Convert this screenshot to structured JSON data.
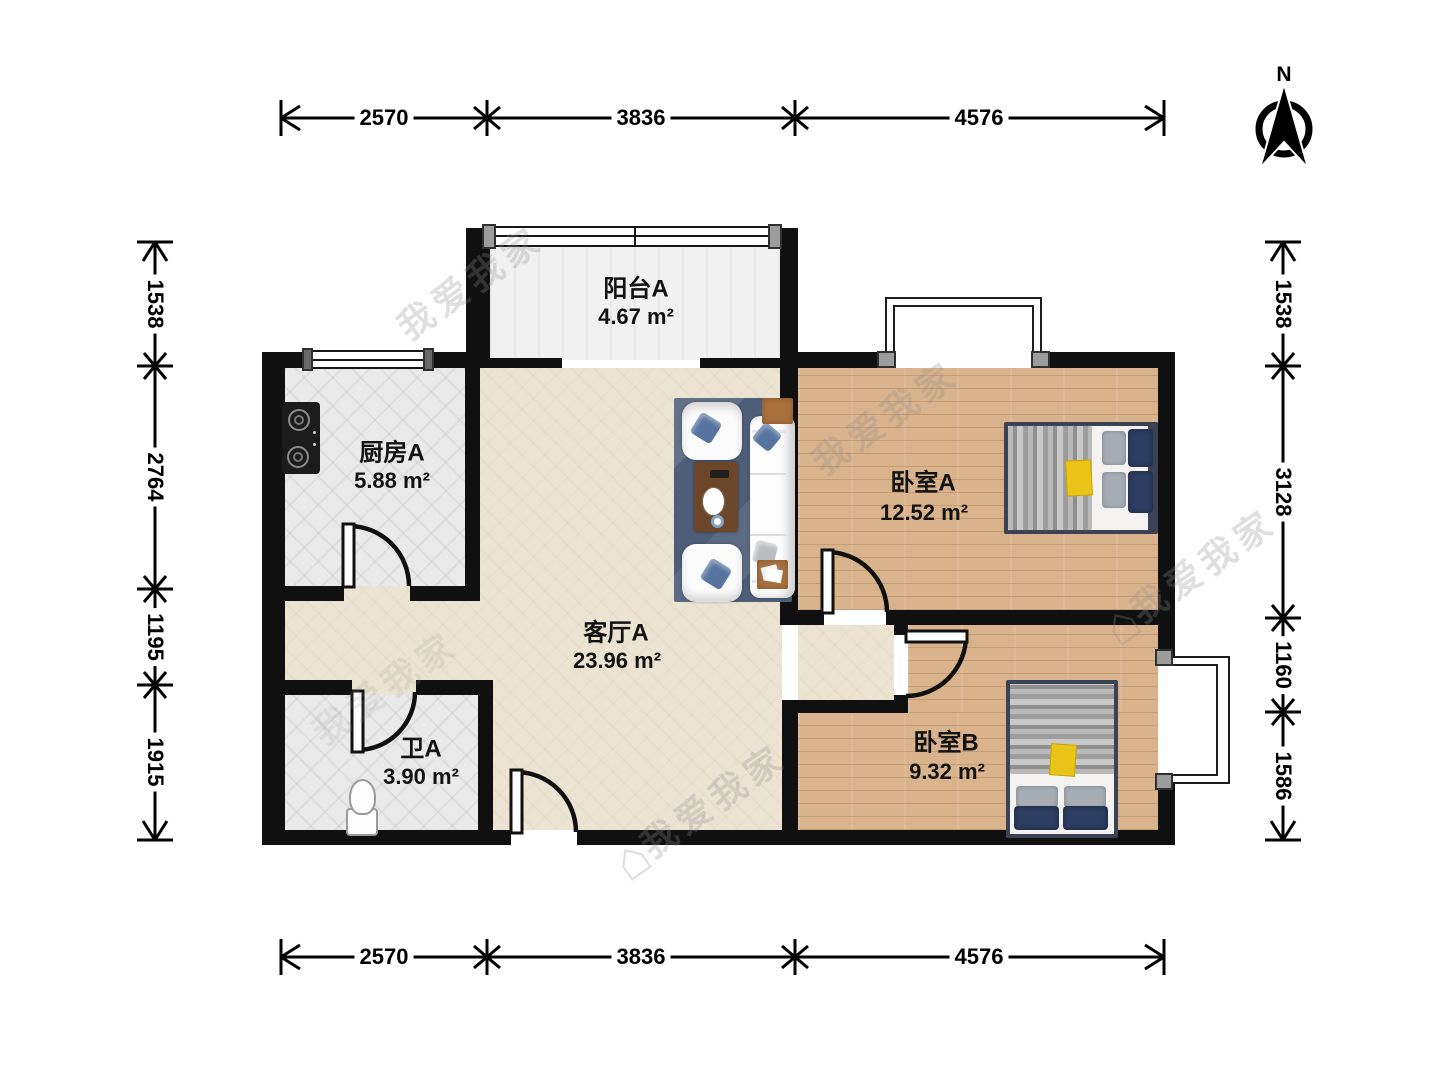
{
  "title": "两室一厅户型图",
  "compass": {
    "north_label": "N"
  },
  "watermark": {
    "text": "我爱我家"
  },
  "rooms": [
    {
      "id": "balcony",
      "name": "阳台A",
      "area": "4.67 m²"
    },
    {
      "id": "kitchen",
      "name": "厨房A",
      "area": "5.88 m²"
    },
    {
      "id": "living",
      "name": "客厅A",
      "area": "23.96 m²"
    },
    {
      "id": "bathroom",
      "name": "卫A",
      "area": "3.90 m²"
    },
    {
      "id": "bedroomA",
      "name": "卧室A",
      "area": "12.52 m²"
    },
    {
      "id": "bedroomB",
      "name": "卧室B",
      "area": "9.32 m²"
    }
  ],
  "dimensions": {
    "top": [
      "2570",
      "3836",
      "4576"
    ],
    "bottom": [
      "2570",
      "3836",
      "4576"
    ],
    "left": [
      "1538",
      "2764",
      "1195",
      "1915"
    ],
    "right": [
      "1538",
      "3128",
      "1160",
      "1586"
    ]
  }
}
